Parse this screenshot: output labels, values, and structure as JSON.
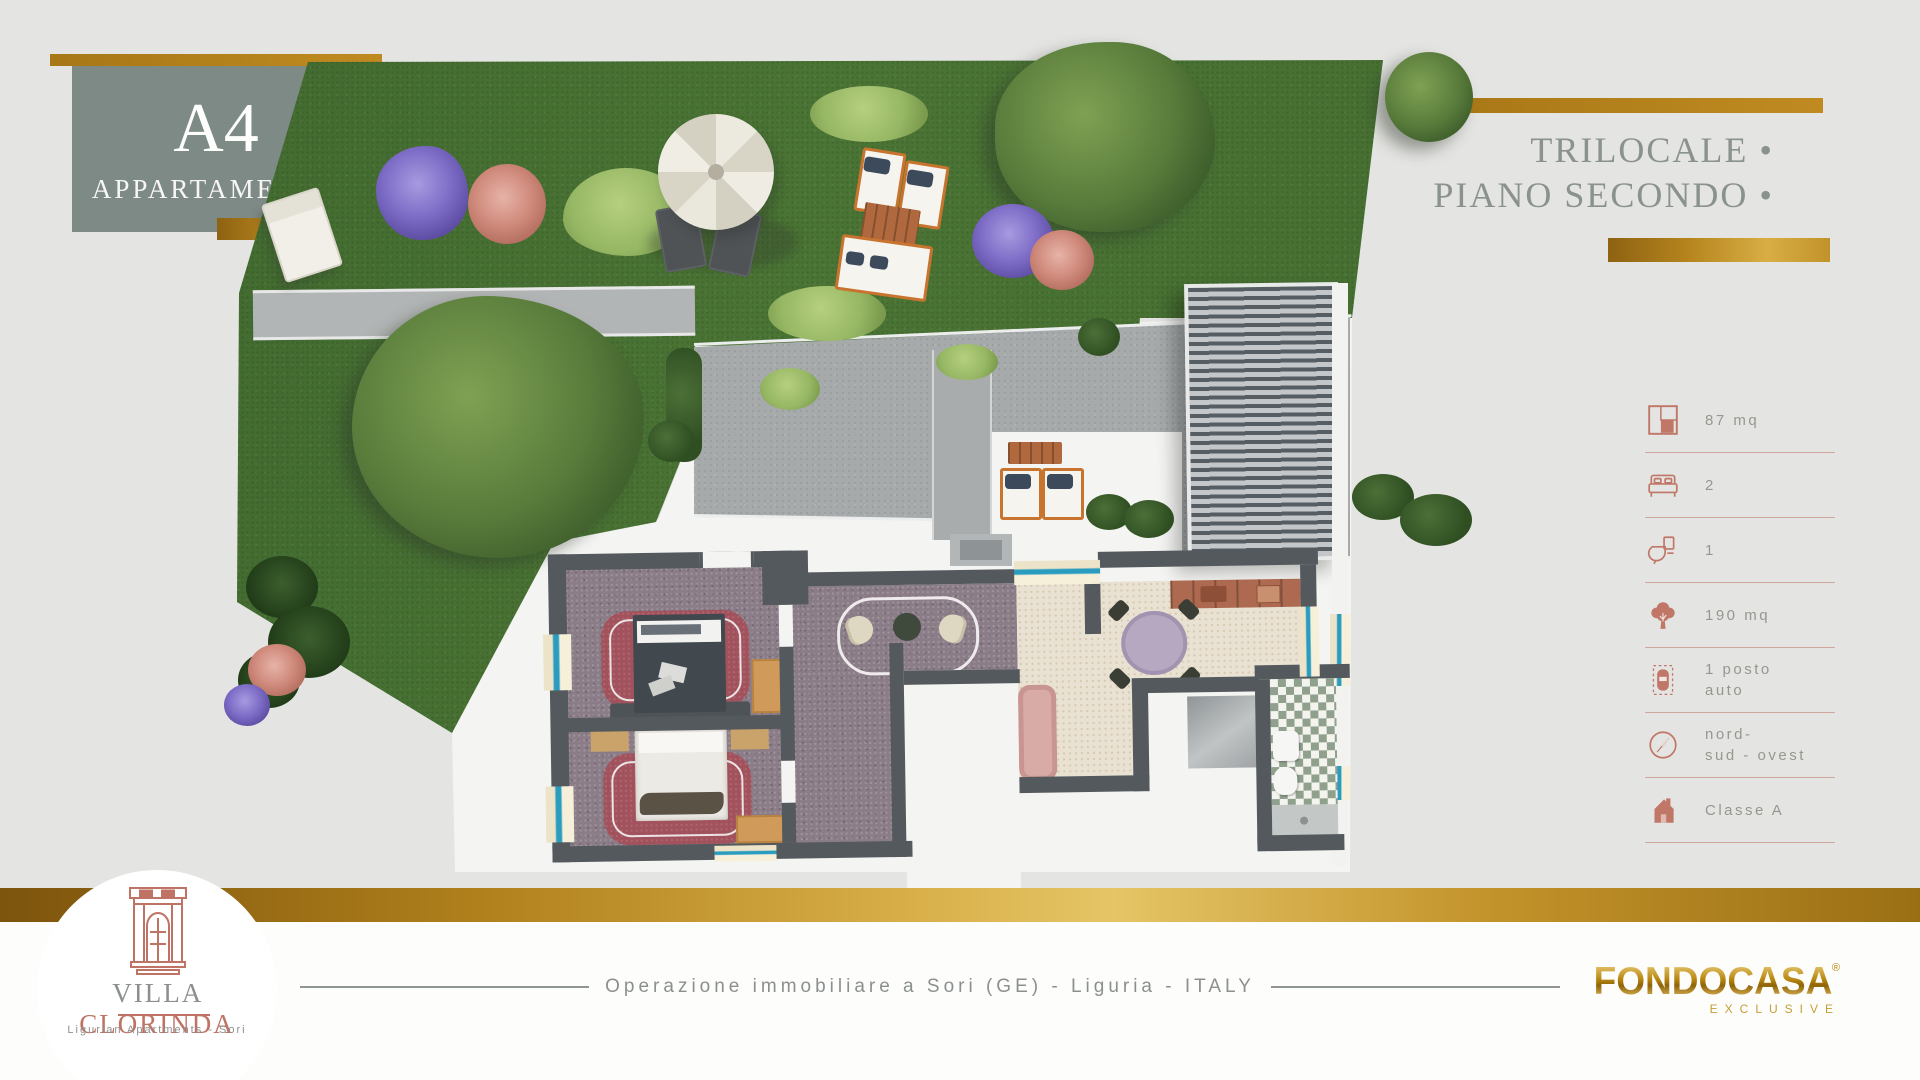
{
  "title_block": {
    "unit": "A4",
    "label": "APPARTAMENTO"
  },
  "type_block": {
    "line1": "TRILOCALE •",
    "line2": "PIANO SECONDO •"
  },
  "specs": {
    "items": [
      {
        "icon": "floor-area-icon",
        "label": "87 mq"
      },
      {
        "icon": "bedrooms-icon",
        "label": "2"
      },
      {
        "icon": "bathrooms-icon",
        "label": "1"
      },
      {
        "icon": "garden-area-icon",
        "label": "190 mq"
      },
      {
        "icon": "parking-icon",
        "label": "1 posto\nauto"
      },
      {
        "icon": "orientation-icon",
        "label": "nord-\nsud - ovest"
      },
      {
        "icon": "energy-class-icon",
        "label": "Classe A"
      }
    ]
  },
  "footer": {
    "brand_word1": "VILLA",
    "brand_word2": "CLORINDA",
    "brand_subtitle": "Ligurian Apartments - Sori",
    "center_text": "Operazione immobiliare a Sori (GE) - Liguria - ITALY",
    "agency_name": "FONDOCASA",
    "agency_mark": "®",
    "agency_subtitle": "EXCLUSIVE"
  },
  "colors": {
    "gold": "#b5831d",
    "terracotta": "#bf7365",
    "sage_box": "#7e8a86",
    "title_gray": "#8a9290",
    "lawn_green": "#46702f",
    "wall_gray": "#54595d"
  }
}
